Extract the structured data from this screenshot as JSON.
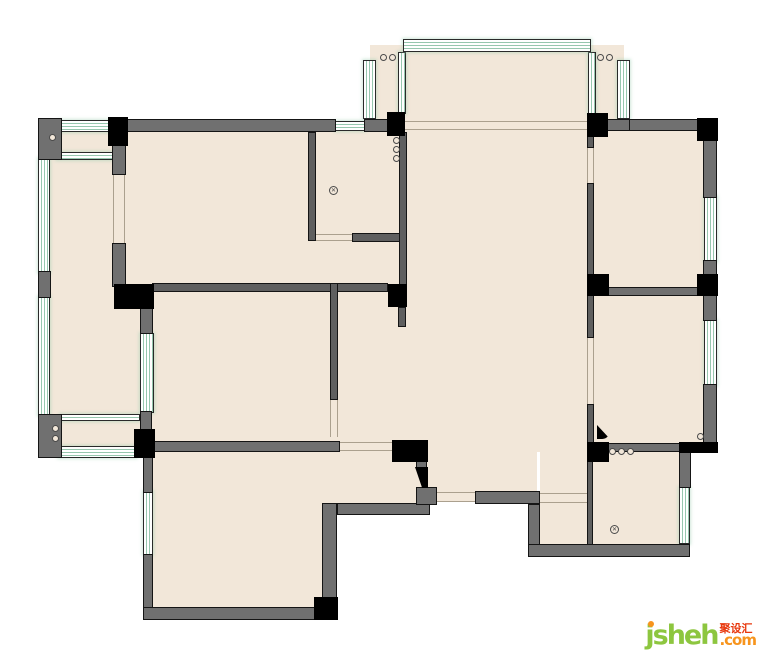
{
  "watermark": {
    "brand": "jsheh",
    "dotcom": ".com",
    "cjk": "聚设汇"
  },
  "palette": {
    "floor": "#f2e7d9",
    "wall": "#707070",
    "wall_thin": "#5f5f5f",
    "black": "#000000",
    "window_line": "#96c7ae",
    "threshold": "#aba08e",
    "logo_green": "#8dc63f",
    "logo_orange": "#f7941d",
    "logo_red": "#e8380d"
  },
  "plan": {
    "floors": [
      [
        44,
        126,
        668,
        326
      ],
      [
        370,
        45,
        254,
        81
      ],
      [
        148,
        452,
        280,
        60
      ],
      [
        148,
        512,
        182,
        100
      ],
      [
        427,
        452,
        110,
        50
      ],
      [
        540,
        452,
        146,
        96
      ]
    ],
    "walls": [
      [
        38,
        118,
        24,
        42
      ],
      [
        38,
        271,
        13,
        27
      ],
      [
        38,
        414,
        24,
        44
      ],
      [
        124,
        119,
        212,
        13
      ],
      [
        364,
        119,
        26,
        13
      ],
      [
        628,
        119,
        72,
        12
      ],
      [
        607,
        119,
        23,
        12
      ],
      [
        112,
        143,
        14,
        32
      ],
      [
        112,
        243,
        14,
        44
      ],
      [
        140,
        307,
        13,
        27
      ],
      [
        140,
        411,
        12,
        20
      ],
      [
        143,
        455,
        10,
        38
      ],
      [
        143,
        554,
        10,
        66
      ],
      [
        143,
        607,
        194,
        13
      ],
      [
        322,
        503,
        15,
        97
      ],
      [
        337,
        503,
        93,
        12
      ],
      [
        416,
        461,
        11,
        9
      ],
      [
        416,
        487,
        21,
        18
      ],
      [
        475,
        491,
        65,
        13
      ],
      [
        528,
        504,
        12,
        53
      ],
      [
        528,
        544,
        162,
        13
      ],
      [
        679,
        452,
        12,
        36
      ],
      [
        703,
        138,
        14,
        60
      ],
      [
        703,
        260,
        14,
        16
      ],
      [
        703,
        294,
        14,
        27
      ],
      [
        703,
        384,
        14,
        59
      ],
      [
        606,
        287,
        92,
        9
      ],
      [
        608,
        443,
        72,
        9
      ],
      [
        152,
        441,
        188,
        11
      ]
    ],
    "thin_walls": [
      [
        308,
        132,
        8,
        109
      ],
      [
        352,
        233,
        55,
        9
      ],
      [
        399,
        132,
        8,
        155
      ],
      [
        152,
        283,
        236,
        9
      ],
      [
        330,
        283,
        8,
        117
      ],
      [
        587,
        135,
        7,
        13
      ],
      [
        587,
        183,
        7,
        94
      ],
      [
        587,
        295,
        7,
        43
      ],
      [
        587,
        404,
        7,
        39
      ],
      [
        587,
        461,
        6,
        84
      ],
      [
        398,
        307,
        8,
        20
      ]
    ],
    "windows_v": [
      [
        38,
        158,
        12,
        115
      ],
      [
        38,
        296,
        12,
        120
      ],
      [
        140,
        333,
        14,
        80
      ],
      [
        363,
        60,
        13,
        59
      ],
      [
        617,
        60,
        13,
        59
      ],
      [
        398,
        52,
        8,
        62
      ],
      [
        588,
        52,
        8,
        62
      ],
      [
        704,
        196,
        13,
        66
      ],
      [
        704,
        320,
        13,
        66
      ],
      [
        679,
        487,
        11,
        57
      ],
      [
        143,
        491,
        10,
        64
      ]
    ],
    "windows_h": [
      [
        58,
        120,
        52,
        12
      ],
      [
        56,
        152,
        59,
        8
      ],
      [
        60,
        414,
        80,
        7
      ],
      [
        58,
        446,
        79,
        12
      ],
      [
        403,
        39,
        188,
        13
      ],
      [
        335,
        121,
        30,
        10
      ]
    ],
    "thresholds_h": [
      [
        404,
        121,
        184,
        9
      ],
      [
        316,
        234,
        36,
        7
      ],
      [
        340,
        442,
        53,
        9
      ],
      [
        437,
        492,
        38,
        10
      ],
      [
        540,
        493,
        47,
        10
      ]
    ],
    "thresholds_v": [
      [
        113,
        175,
        12,
        68
      ],
      [
        587,
        148,
        7,
        35
      ],
      [
        587,
        338,
        7,
        66
      ],
      [
        330,
        400,
        8,
        37
      ]
    ],
    "columns": [
      [
        108,
        117,
        20,
        29
      ],
      [
        387,
        112,
        18,
        24
      ],
      [
        587,
        113,
        21,
        24
      ],
      [
        697,
        118,
        21,
        23
      ],
      [
        114,
        284,
        40,
        25
      ],
      [
        587,
        274,
        22,
        22
      ],
      [
        697,
        274,
        21,
        22
      ],
      [
        134,
        429,
        21,
        29
      ],
      [
        314,
        597,
        24,
        23
      ],
      [
        392,
        440,
        36,
        22
      ],
      [
        587,
        442,
        22,
        20
      ],
      [
        679,
        442,
        39,
        11
      ],
      [
        388,
        284,
        19,
        23
      ]
    ],
    "circles": [
      [
        52,
        137
      ],
      [
        383,
        57
      ],
      [
        392,
        57
      ],
      [
        600,
        57
      ],
      [
        609,
        57
      ],
      [
        396,
        140
      ],
      [
        396,
        149
      ],
      [
        396,
        158
      ],
      [
        55,
        428
      ],
      [
        55,
        438
      ],
      [
        612,
        451
      ],
      [
        621,
        451
      ],
      [
        630,
        451
      ],
      [
        700,
        436
      ]
    ],
    "drains": [
      [
        333,
        190
      ],
      [
        614,
        529
      ]
    ],
    "doors": [
      {
        "x": 415,
        "y": 467,
        "w": 13,
        "h": 21,
        "cls": "door-entry",
        "name": "entry-door-leaf"
      },
      {
        "x": 597,
        "y": 425,
        "w": 13,
        "h": 14,
        "cls": "door-swing",
        "name": "bedroom-door-leaf"
      }
    ]
  }
}
